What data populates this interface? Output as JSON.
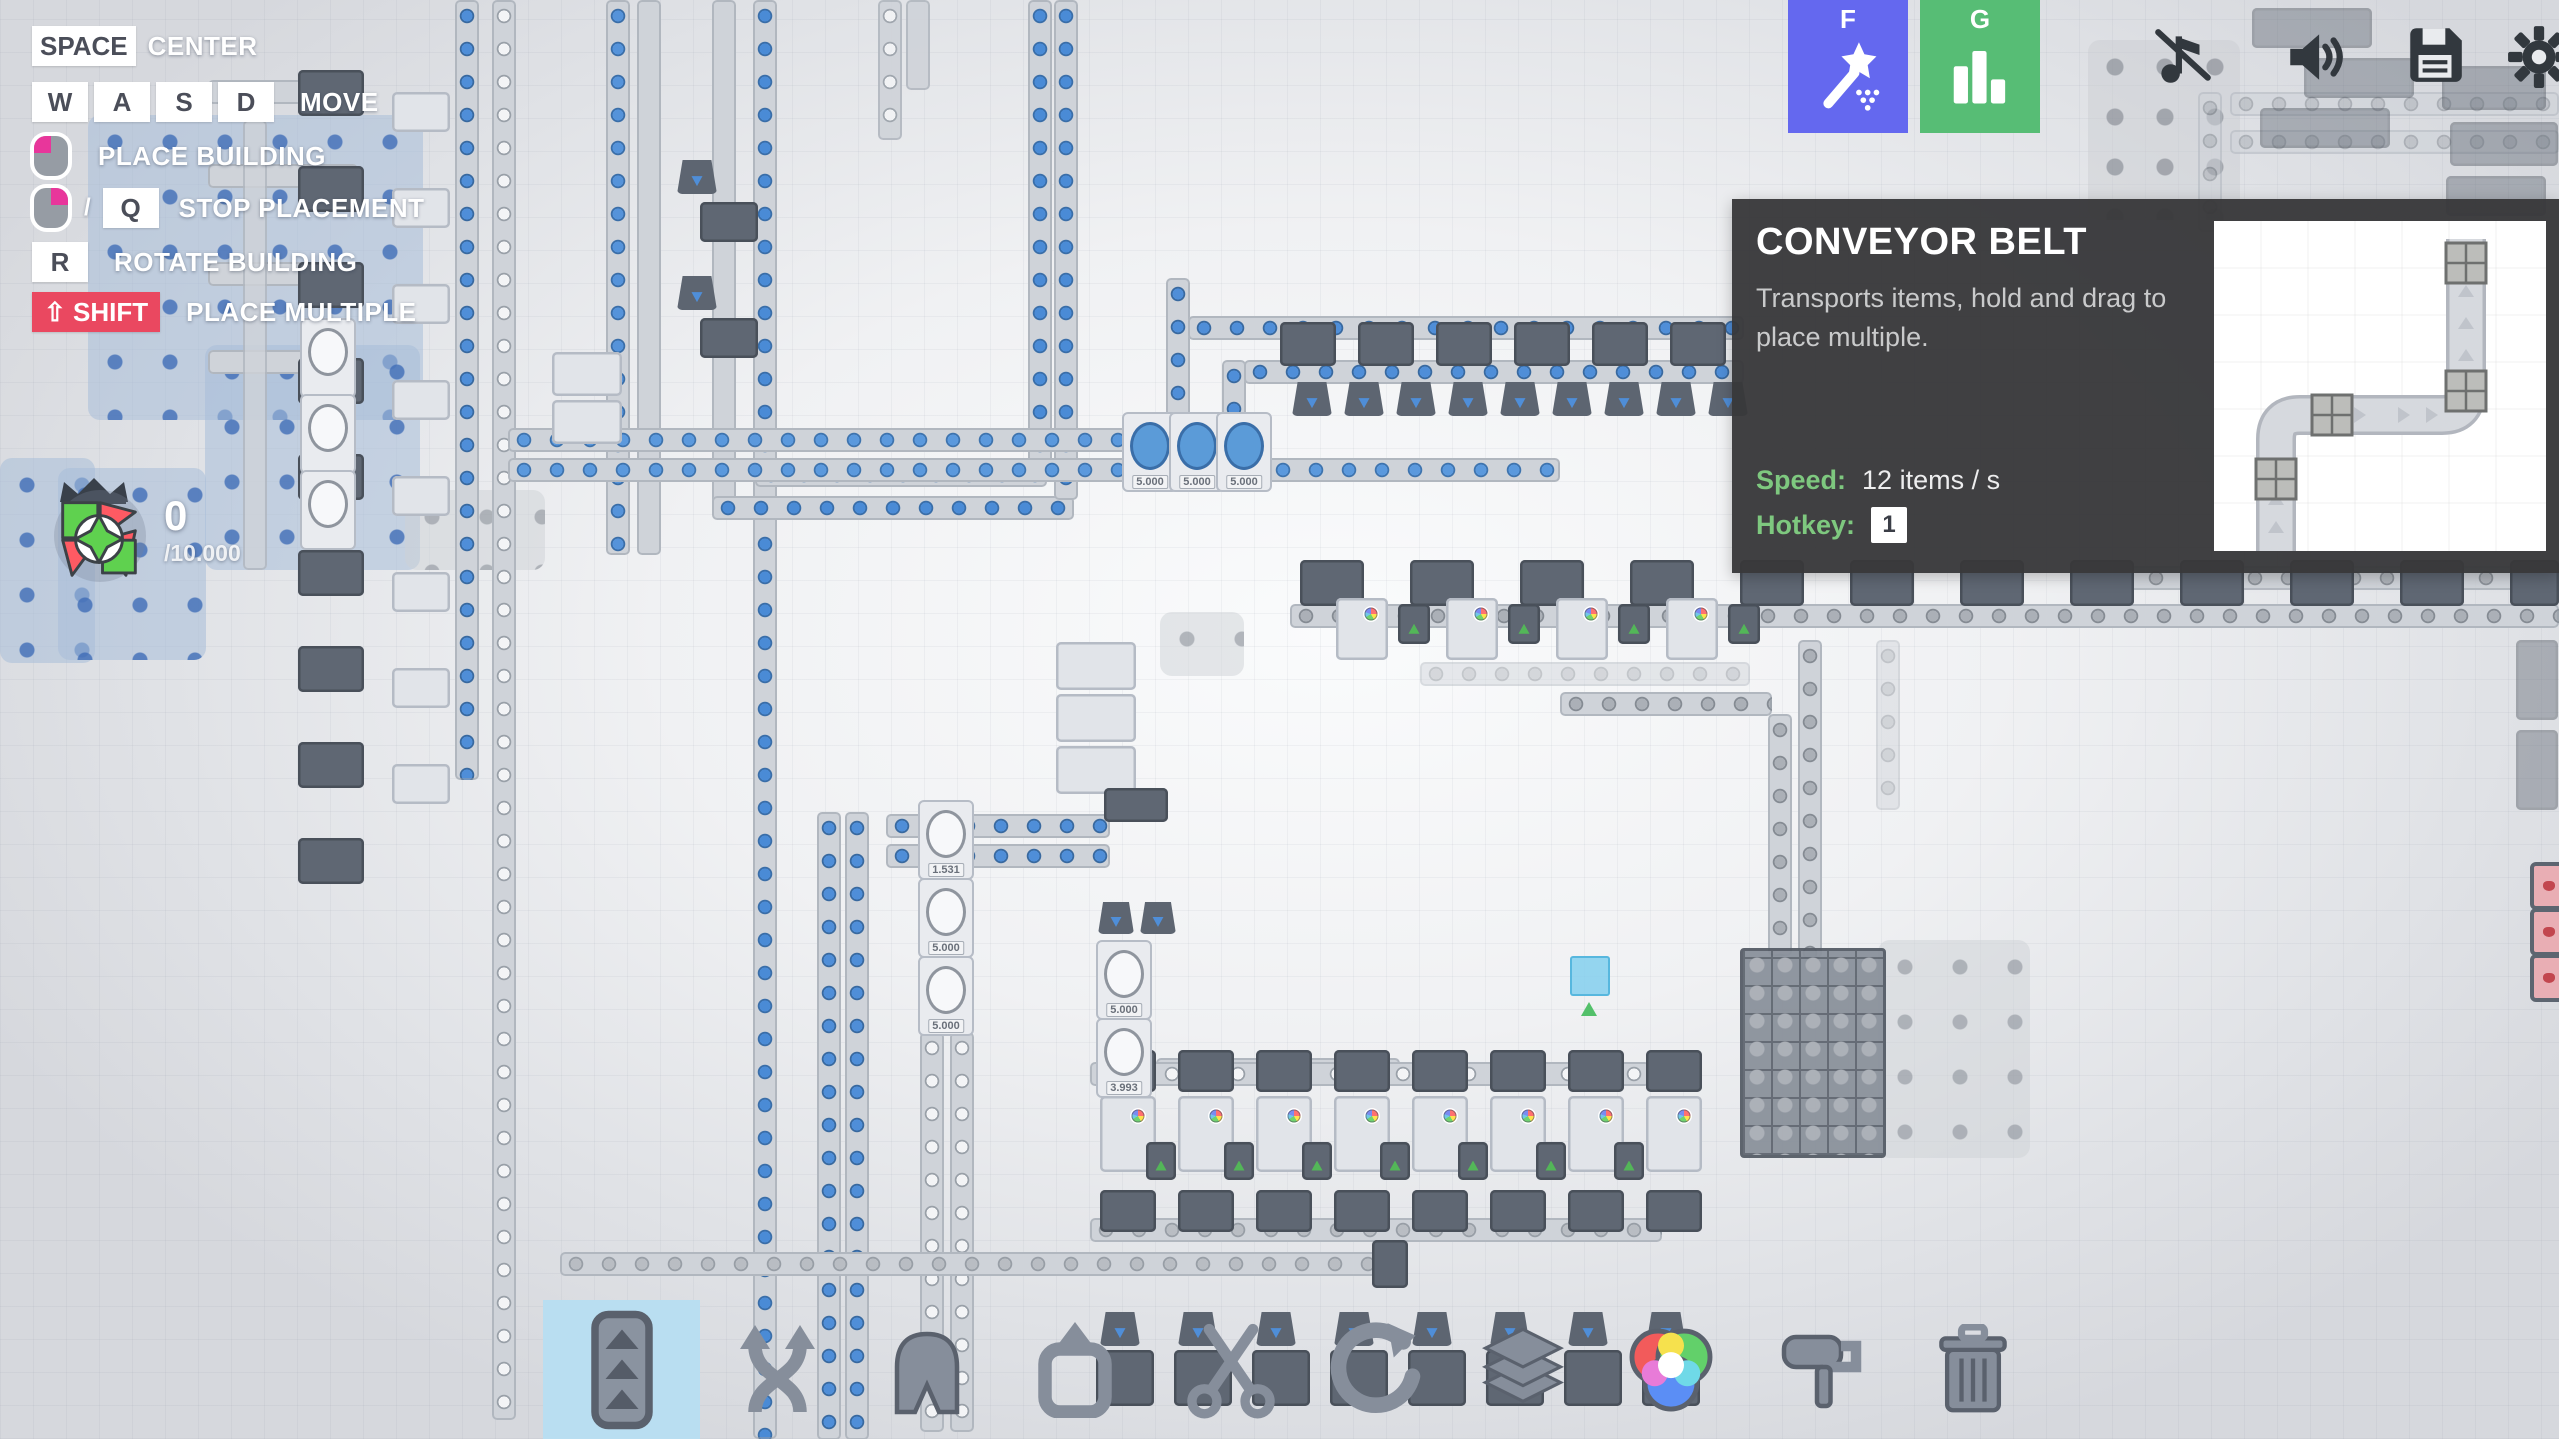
{
  "hud": {
    "keys": {
      "space": "SPACE",
      "w": "W",
      "a": "A",
      "s": "S",
      "d": "D",
      "q": "Q",
      "r": "R",
      "shift": "⇧ SHIFT",
      "slash": "/",
      "center": "CENTER",
      "move": "MOVE",
      "place": "PLACE BUILDING",
      "stop": "STOP PLACEMENT",
      "rotate": "ROTATE BUILDING",
      "multiple": "PLACE MULTIPLE"
    },
    "goal": {
      "count": "0",
      "total": "/10.000"
    },
    "buttons": {
      "blueprint_hotkey": "F",
      "stats_hotkey": "G"
    },
    "icons": [
      "magic-wand-icon",
      "bar-chart-icon",
      "music-muted-icon",
      "speaker-icon",
      "save-icon",
      "gear-icon"
    ]
  },
  "tooltip": {
    "title": "CONVEYOR BELT",
    "description": "Transports items, hold and drag to place multiple.",
    "speed_label": "Speed:",
    "speed_value": "12 items / s",
    "hotkey_label": "Hotkey:",
    "hotkey_value": "1"
  },
  "toolbar": {
    "selected": "belt",
    "buttons": [
      "belt",
      "balancer",
      "tunnel",
      "extractor",
      "cutter",
      "rotator",
      "stacker",
      "mixer",
      "painter",
      "trash"
    ]
  },
  "colors": {
    "blueprint_btn": "#6468ef",
    "stats_btn": "#57bd75",
    "shift_badge": "#ea4860",
    "mouse_accent": "#e8369b",
    "tooltip_bg": "#383838",
    "tooltip_label": "#7ec87f",
    "selected_tool_bg": "#b9def1",
    "item_blue": "#4f8ed8"
  },
  "factory": {
    "patches_blue": [
      [
        88,
        115,
        335,
        305
      ],
      [
        205,
        345,
        215,
        225
      ],
      [
        0,
        458,
        95,
        205
      ],
      [
        58,
        468,
        148,
        192
      ]
    ],
    "patches_gray": [
      [
        405,
        490,
        140,
        80
      ],
      [
        1878,
        940,
        152,
        218
      ],
      [
        1160,
        612,
        84,
        64
      ]
    ],
    "patches_win": [
      [
        2088,
        40,
        152,
        180
      ]
    ],
    "belts": [
      [
        208,
        80,
        150,
        "h",
        "plain",
        1
      ],
      [
        208,
        164,
        150,
        "h",
        "plain",
        1
      ],
      [
        208,
        262,
        150,
        "h",
        "plain",
        1
      ],
      [
        208,
        350,
        110,
        "h",
        "plain",
        1
      ],
      [
        243,
        120,
        450,
        "v",
        "plain",
        0.8
      ],
      [
        455,
        0,
        780,
        "v",
        "pin",
        1
      ],
      [
        492,
        0,
        1420,
        "v",
        "circle",
        1
      ],
      [
        606,
        0,
        555,
        "v",
        "half",
        1
      ],
      [
        637,
        0,
        555,
        "v",
        "plain",
        1
      ],
      [
        712,
        0,
        518,
        "v",
        "plain",
        1
      ],
      [
        753,
        0,
        1439,
        "v",
        "wind",
        1
      ],
      [
        712,
        496,
        362,
        "h",
        "wind",
        1
      ],
      [
        755,
        463,
        292,
        "h",
        "wind",
        1
      ],
      [
        1028,
        0,
        468,
        "v",
        "wind",
        1
      ],
      [
        1054,
        0,
        500,
        "v",
        "wind",
        1
      ],
      [
        1166,
        278,
        212,
        "v",
        "pin",
        1
      ],
      [
        1188,
        316,
        556,
        "h",
        "pin",
        1
      ],
      [
        1222,
        360,
        130,
        "v",
        "pin",
        1
      ],
      [
        1244,
        360,
        500,
        "h",
        "pin",
        1
      ],
      [
        508,
        428,
        620,
        "h",
        "quarter",
        1
      ],
      [
        508,
        458,
        1052,
        "h",
        "quarter",
        1
      ],
      [
        817,
        812,
        628,
        "v",
        "pin",
        1
      ],
      [
        845,
        812,
        628,
        "v",
        "pin",
        1
      ],
      [
        886,
        814,
        224,
        "h",
        "pin",
        1
      ],
      [
        886,
        844,
        224,
        "h",
        "pin",
        1
      ],
      [
        920,
        1032,
        400,
        "v",
        "circle",
        1
      ],
      [
        950,
        1032,
        400,
        "v",
        "circle",
        1
      ],
      [
        1156,
        1058,
        244,
        "h",
        "circle",
        1
      ],
      [
        560,
        1252,
        840,
        "h",
        "gray",
        1
      ],
      [
        1090,
        1062,
        560,
        "h",
        "circle",
        1
      ],
      [
        1090,
        1218,
        572,
        "h",
        "gray",
        1
      ],
      [
        1290,
        604,
        1269,
        "h",
        "win",
        1
      ],
      [
        1560,
        692,
        212,
        "h",
        "win",
        1
      ],
      [
        1798,
        640,
        318,
        "v",
        "win",
        1
      ],
      [
        1768,
        714,
        242,
        "v",
        "win",
        1
      ],
      [
        2107,
        566,
        452,
        "h",
        "win",
        0.9
      ],
      [
        1420,
        662,
        330,
        "h",
        "win",
        0.45
      ],
      [
        1876,
        640,
        170,
        "v",
        "win",
        0.45
      ],
      [
        2230,
        92,
        329,
        "h",
        "win",
        0.55
      ],
      [
        2230,
        130,
        329,
        "h",
        "win",
        0.55
      ],
      [
        2198,
        92,
        140,
        "v",
        "win",
        0.55
      ],
      [
        878,
        0,
        140,
        "v",
        "circle",
        0.9
      ],
      [
        906,
        0,
        90,
        "v",
        "plain",
        0.9
      ]
    ],
    "buildings": [
      [
        298,
        70,
        66,
        46,
        "d",
        ""
      ],
      [
        298,
        166,
        66,
        46,
        "d",
        ""
      ],
      [
        298,
        262,
        66,
        46,
        "d",
        ""
      ],
      [
        298,
        358,
        66,
        46,
        "d",
        ""
      ],
      [
        298,
        454,
        66,
        46,
        "d",
        ""
      ],
      [
        298,
        550,
        66,
        46,
        "d",
        ""
      ],
      [
        298,
        646,
        66,
        46,
        "d",
        ""
      ],
      [
        298,
        742,
        66,
        46,
        "d",
        ""
      ],
      [
        298,
        838,
        66,
        46,
        "d",
        ""
      ],
      [
        392,
        92,
        58,
        40,
        "l",
        ""
      ],
      [
        392,
        188,
        58,
        40,
        "l",
        ""
      ],
      [
        392,
        284,
        58,
        40,
        "l",
        ""
      ],
      [
        392,
        380,
        58,
        40,
        "l",
        ""
      ],
      [
        392,
        476,
        58,
        40,
        "l",
        ""
      ],
      [
        392,
        572,
        58,
        40,
        "l",
        ""
      ],
      [
        392,
        668,
        58,
        40,
        "l",
        ""
      ],
      [
        392,
        764,
        58,
        40,
        "l",
        ""
      ],
      [
        677,
        160,
        40,
        34,
        "t",
        "b"
      ],
      [
        677,
        276,
        40,
        34,
        "t",
        "b"
      ],
      [
        700,
        202,
        58,
        40,
        "d",
        ""
      ],
      [
        700,
        318,
        58,
        40,
        "d",
        ""
      ],
      [
        552,
        352,
        70,
        44,
        "l",
        ""
      ],
      [
        552,
        400,
        70,
        44,
        "l",
        ""
      ],
      [
        1056,
        642,
        80,
        48,
        "l",
        ""
      ],
      [
        1056,
        694,
        80,
        48,
        "l",
        ""
      ],
      [
        1056,
        746,
        80,
        48,
        "l",
        ""
      ],
      [
        1104,
        788,
        64,
        34,
        "d",
        ""
      ],
      [
        1280,
        322,
        56,
        44,
        "d",
        ""
      ],
      [
        1358,
        322,
        56,
        44,
        "d",
        ""
      ],
      [
        1436,
        322,
        56,
        44,
        "d",
        ""
      ],
      [
        1514,
        322,
        56,
        44,
        "d",
        ""
      ],
      [
        1592,
        322,
        56,
        44,
        "d",
        ""
      ],
      [
        1670,
        322,
        56,
        44,
        "d",
        ""
      ],
      [
        1292,
        382,
        40,
        34,
        "t",
        "b"
      ],
      [
        1344,
        382,
        40,
        34,
        "t",
        "b"
      ],
      [
        1396,
        382,
        40,
        34,
        "t",
        "b"
      ],
      [
        1448,
        382,
        40,
        34,
        "t",
        "b"
      ],
      [
        1500,
        382,
        40,
        34,
        "t",
        "b"
      ],
      [
        1552,
        382,
        40,
        34,
        "t",
        "b"
      ],
      [
        1604,
        382,
        40,
        34,
        "t",
        "b"
      ],
      [
        1656,
        382,
        40,
        34,
        "t",
        "b"
      ],
      [
        1708,
        382,
        40,
        34,
        "t",
        "b"
      ],
      [
        1300,
        560,
        64,
        46,
        "d",
        ""
      ],
      [
        1410,
        560,
        64,
        46,
        "d",
        ""
      ],
      [
        1520,
        560,
        64,
        46,
        "d",
        ""
      ],
      [
        1630,
        560,
        64,
        46,
        "d",
        ""
      ],
      [
        1740,
        560,
        64,
        46,
        "d",
        ""
      ],
      [
        1850,
        560,
        64,
        46,
        "d",
        ""
      ],
      [
        1960,
        560,
        64,
        46,
        "d",
        ""
      ],
      [
        2070,
        560,
        64,
        46,
        "d",
        ""
      ],
      [
        2180,
        560,
        64,
        46,
        "d",
        ""
      ],
      [
        2290,
        560,
        64,
        46,
        "d",
        ""
      ],
      [
        2400,
        560,
        64,
        46,
        "d",
        ""
      ],
      [
        2510,
        560,
        49,
        46,
        "d",
        ""
      ],
      [
        1336,
        598,
        52,
        62,
        "l",
        "rgb"
      ],
      [
        1446,
        598,
        52,
        62,
        "l",
        "rgb"
      ],
      [
        1556,
        598,
        52,
        62,
        "l",
        "rgb"
      ],
      [
        1666,
        598,
        52,
        62,
        "l",
        "rgb"
      ],
      [
        1398,
        604,
        32,
        40,
        "d",
        "g"
      ],
      [
        1508,
        604,
        32,
        40,
        "d",
        "g"
      ],
      [
        1618,
        604,
        32,
        40,
        "d",
        "g"
      ],
      [
        1728,
        604,
        32,
        40,
        "d",
        "g"
      ],
      [
        1100,
        1050,
        56,
        42,
        "d",
        ""
      ],
      [
        1178,
        1050,
        56,
        42,
        "d",
        ""
      ],
      [
        1256,
        1050,
        56,
        42,
        "d",
        ""
      ],
      [
        1334,
        1050,
        56,
        42,
        "d",
        ""
      ],
      [
        1412,
        1050,
        56,
        42,
        "d",
        ""
      ],
      [
        1490,
        1050,
        56,
        42,
        "d",
        ""
      ],
      [
        1568,
        1050,
        56,
        42,
        "d",
        ""
      ],
      [
        1646,
        1050,
        56,
        42,
        "d",
        ""
      ],
      [
        1100,
        1096,
        56,
        76,
        "l",
        "rgb"
      ],
      [
        1178,
        1096,
        56,
        76,
        "l",
        "rgb"
      ],
      [
        1256,
        1096,
        56,
        76,
        "l",
        "rgb"
      ],
      [
        1334,
        1096,
        56,
        76,
        "l",
        "rgb"
      ],
      [
        1412,
        1096,
        56,
        76,
        "l",
        "rgb"
      ],
      [
        1490,
        1096,
        56,
        76,
        "l",
        "rgb"
      ],
      [
        1568,
        1096,
        56,
        76,
        "l",
        "rgb"
      ],
      [
        1646,
        1096,
        56,
        76,
        "l",
        "rgb"
      ],
      [
        1146,
        1142,
        30,
        38,
        "d",
        "g"
      ],
      [
        1224,
        1142,
        30,
        38,
        "d",
        "g"
      ],
      [
        1302,
        1142,
        30,
        38,
        "d",
        "g"
      ],
      [
        1380,
        1142,
        30,
        38,
        "d",
        "g"
      ],
      [
        1458,
        1142,
        30,
        38,
        "d",
        "g"
      ],
      [
        1536,
        1142,
        30,
        38,
        "d",
        "g"
      ],
      [
        1614,
        1142,
        30,
        38,
        "d",
        "g"
      ],
      [
        1100,
        1190,
        56,
        42,
        "d",
        ""
      ],
      [
        1178,
        1190,
        56,
        42,
        "d",
        ""
      ],
      [
        1256,
        1190,
        56,
        42,
        "d",
        ""
      ],
      [
        1334,
        1190,
        56,
        42,
        "d",
        ""
      ],
      [
        1412,
        1190,
        56,
        42,
        "d",
        ""
      ],
      [
        1490,
        1190,
        56,
        42,
        "d",
        ""
      ],
      [
        1568,
        1190,
        56,
        42,
        "d",
        ""
      ],
      [
        1646,
        1190,
        56,
        42,
        "d",
        ""
      ],
      [
        1100,
        1312,
        40,
        34,
        "t",
        "b"
      ],
      [
        1178,
        1312,
        40,
        34,
        "t",
        "b"
      ],
      [
        1256,
        1312,
        40,
        34,
        "t",
        "b"
      ],
      [
        1334,
        1312,
        40,
        34,
        "t",
        "b"
      ],
      [
        1412,
        1312,
        40,
        34,
        "t",
        "b"
      ],
      [
        1490,
        1312,
        40,
        34,
        "t",
        "b"
      ],
      [
        1568,
        1312,
        40,
        34,
        "t",
        "b"
      ],
      [
        1646,
        1312,
        40,
        34,
        "t",
        "b"
      ],
      [
        1096,
        1350,
        58,
        56,
        "d",
        ""
      ],
      [
        1174,
        1350,
        58,
        56,
        "d",
        ""
      ],
      [
        1252,
        1350,
        58,
        56,
        "d",
        ""
      ],
      [
        1330,
        1350,
        58,
        56,
        "d",
        ""
      ],
      [
        1408,
        1350,
        58,
        56,
        "d",
        ""
      ],
      [
        1486,
        1350,
        58,
        56,
        "d",
        ""
      ],
      [
        1564,
        1350,
        58,
        56,
        "d",
        ""
      ],
      [
        1642,
        1350,
        58,
        56,
        "d",
        ""
      ],
      [
        1372,
        1240,
        36,
        48,
        "d",
        ""
      ],
      [
        1098,
        902,
        36,
        32,
        "t",
        "b"
      ],
      [
        1140,
        902,
        36,
        32,
        "t",
        "b"
      ],
      [
        2252,
        8,
        120,
        40,
        "g",
        ""
      ],
      [
        2304,
        58,
        110,
        40,
        "g",
        ""
      ],
      [
        2260,
        108,
        130,
        40,
        "g",
        ""
      ],
      [
        2442,
        66,
        104,
        44,
        "g",
        ""
      ],
      [
        2450,
        122,
        108,
        44,
        "g",
        ""
      ],
      [
        2446,
        176,
        100,
        40,
        "g",
        ""
      ],
      [
        2516,
        640,
        42,
        80,
        "g",
        ""
      ],
      [
        2516,
        730,
        42,
        80,
        "g",
        ""
      ]
    ],
    "storages": [
      [
        1122,
        412,
        "5.000",
        "blue"
      ],
      [
        1169,
        412,
        "5.000",
        "blue"
      ],
      [
        1216,
        412,
        "5.000",
        "blue"
      ],
      [
        918,
        800,
        "1.531",
        ""
      ],
      [
        918,
        878,
        "5.000",
        ""
      ],
      [
        918,
        956,
        "5.000",
        ""
      ],
      [
        1096,
        940,
        "5.000",
        ""
      ],
      [
        1096,
        1018,
        "3.993",
        ""
      ],
      [
        300,
        318,
        "",
        ""
      ],
      [
        300,
        394,
        "",
        ""
      ],
      [
        300,
        470,
        "",
        ""
      ]
    ],
    "extractor_grids": [
      [
        1740,
        948,
        140,
        204
      ]
    ],
    "red_cells": [
      [
        2530,
        862
      ],
      [
        2530,
        908
      ],
      [
        2530,
        954
      ]
    ]
  }
}
